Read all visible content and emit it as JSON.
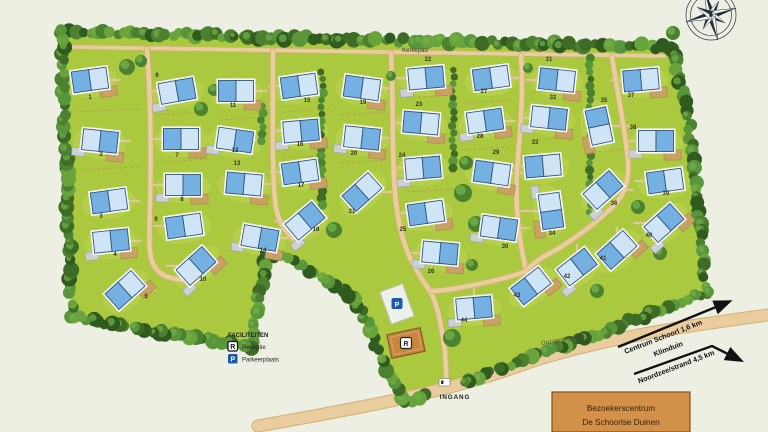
{
  "map": {
    "roads": {
      "kerkepad": "Kerkepad",
      "oorsprongweg": "Oorsprongweg"
    },
    "entrance_label": "INGANG",
    "legend": {
      "title": "FACILITEITEN",
      "items": [
        {
          "icon": "R",
          "label": "Receptie"
        },
        {
          "icon": "P",
          "label": "Parkeerplaats"
        }
      ]
    },
    "directions": [
      {
        "line1": "Centrum Schoorl 1,6 km",
        "line2": "Klimduin"
      },
      {
        "line1": "Noordzee/strand 4,5 km",
        "line2": ""
      }
    ],
    "visitor_center": {
      "line1": "Bezoekerscentrum",
      "line2": "De Schoorlse Duinen"
    },
    "compass_icon": "compass-rose-icon",
    "colors": {
      "background": "#edefe3",
      "park_green": "#aac93f",
      "lawn_light": "#c0d558",
      "tree_dark": "#3e6b26",
      "road_tan": "#e9cd9e",
      "house_blue_light": "#cfe4f5",
      "house_blue_mid": "#74b0e2",
      "house_outline": "#2e567d",
      "garage_tan": "#c8a165",
      "shed_gray": "#ccd0d4",
      "parking_blue": "#1d5aa8",
      "reception_brown": "#c8863f",
      "visitor_box_orange": "#d29049",
      "arrow_black": "#111111"
    },
    "houses": [
      {
        "n": 1,
        "x": 90,
        "y": 80,
        "r": -8,
        "lx": 90,
        "ly": 99,
        "d": "R"
      },
      {
        "n": 2,
        "x": 100,
        "y": 141,
        "r": 6,
        "lx": 101,
        "ly": 156,
        "d": "R"
      },
      {
        "n": 3,
        "x": 109,
        "y": 201,
        "r": -8,
        "lx": 101,
        "ly": 218,
        "d": "R"
      },
      {
        "n": 4,
        "x": 111,
        "y": 241,
        "r": -6,
        "lx": 115,
        "ly": 256,
        "d": "R"
      },
      {
        "n": 5,
        "x": 125,
        "y": 290,
        "r": -42,
        "lx": 146,
        "ly": 298,
        "d": "R"
      },
      {
        "n": 6,
        "x": 177,
        "y": 91,
        "r": -10,
        "lx": 157,
        "ly": 77,
        "d": "L"
      },
      {
        "n": 7,
        "x": 181,
        "y": 139,
        "r": 0,
        "lx": 177,
        "ly": 157,
        "d": "L"
      },
      {
        "n": 8,
        "x": 183,
        "y": 185,
        "r": 0,
        "lx": 182,
        "ly": 201,
        "d": "L"
      },
      {
        "n": 9,
        "x": 184,
        "y": 226,
        "r": -8,
        "lx": 156,
        "ly": 221,
        "d": "L"
      },
      {
        "n": 10,
        "x": 196,
        "y": 266,
        "r": -42,
        "lx": 203,
        "ly": 281,
        "d": "L"
      },
      {
        "n": 11,
        "x": 236,
        "y": 91,
        "r": 0,
        "lx": 233,
        "ly": 107,
        "d": "R"
      },
      {
        "n": 12,
        "x": 235,
        "y": 140,
        "r": 8,
        "lx": 235,
        "ly": 152,
        "d": "R"
      },
      {
        "n": 13,
        "x": 244,
        "y": 184,
        "r": 5,
        "lx": 237,
        "ly": 165,
        "d": "R"
      },
      {
        "n": 14,
        "x": 260,
        "y": 238,
        "r": 10,
        "lx": 263,
        "ly": 252,
        "d": "R"
      },
      {
        "n": 15,
        "x": 299,
        "y": 86,
        "r": -8,
        "lx": 307,
        "ly": 102,
        "d": "L"
      },
      {
        "n": 16,
        "x": 301,
        "y": 131,
        "r": -5,
        "lx": 300,
        "ly": 146,
        "d": "L"
      },
      {
        "n": 17,
        "x": 300,
        "y": 172,
        "r": -8,
        "lx": 301,
        "ly": 187,
        "d": "L"
      },
      {
        "n": 18,
        "x": 305,
        "y": 221,
        "r": -40,
        "lx": 316,
        "ly": 231,
        "d": "L"
      },
      {
        "n": 19,
        "x": 362,
        "y": 88,
        "r": 8,
        "lx": 363,
        "ly": 104,
        "d": "R"
      },
      {
        "n": 20,
        "x": 362,
        "y": 138,
        "r": 6,
        "lx": 354,
        "ly": 155,
        "d": "R"
      },
      {
        "n": 21,
        "x": 362,
        "y": 192,
        "r": -42,
        "lx": 352,
        "ly": 213,
        "d": "R"
      },
      {
        "n": 22,
        "x": 426,
        "y": 78,
        "r": -5,
        "lx": 428,
        "ly": 61,
        "d": "L"
      },
      {
        "n": 23,
        "x": 421,
        "y": 123,
        "r": 5,
        "lx": 419,
        "ly": 106,
        "d": "L"
      },
      {
        "n": 24,
        "x": 423,
        "y": 168,
        "r": -5,
        "lx": 402,
        "ly": 157,
        "d": "L"
      },
      {
        "n": 25,
        "x": 426,
        "y": 213,
        "r": -8,
        "lx": 403,
        "ly": 231,
        "d": "L"
      },
      {
        "n": 26,
        "x": 440,
        "y": 253,
        "r": 5,
        "lx": 431,
        "ly": 273,
        "d": "L"
      },
      {
        "n": 27,
        "x": 491,
        "y": 78,
        "r": -8,
        "lx": 484,
        "ly": 93,
        "d": "R"
      },
      {
        "n": 28,
        "x": 485,
        "y": 121,
        "r": -8,
        "lx": 480,
        "ly": 138,
        "d": "R"
      },
      {
        "n": 29,
        "x": 492,
        "y": 173,
        "r": 8,
        "lx": 496,
        "ly": 154,
        "d": "R"
      },
      {
        "n": 30,
        "x": 499,
        "y": 228,
        "r": 8,
        "lx": 505,
        "ly": 248,
        "d": "R"
      },
      {
        "n": 31,
        "x": 557,
        "y": 80,
        "r": 6,
        "lx": 549,
        "ly": 61,
        "d": "L"
      },
      {
        "n": 32,
        "x": 549,
        "y": 118,
        "r": 6,
        "lx": 553,
        "ly": 99,
        "d": "L"
      },
      {
        "n": 33,
        "x": 543,
        "y": 166,
        "r": -5,
        "lx": 535,
        "ly": 144,
        "d": "L"
      },
      {
        "n": 34,
        "x": 551,
        "y": 211,
        "r": 82,
        "lx": 552,
        "ly": 235,
        "d": "L"
      },
      {
        "n": 35,
        "x": 599,
        "y": 126,
        "r": 78,
        "lx": 604,
        "ly": 102,
        "d": "R"
      },
      {
        "n": 36,
        "x": 603,
        "y": 190,
        "r": -42,
        "lx": 614,
        "ly": 205,
        "d": "R"
      },
      {
        "n": 37,
        "x": 641,
        "y": 80,
        "r": -5,
        "lx": 631,
        "ly": 97,
        "d": "L"
      },
      {
        "n": 38,
        "x": 656,
        "y": 141,
        "r": 0,
        "lx": 633,
        "ly": 129,
        "d": "L"
      },
      {
        "n": 39,
        "x": 665,
        "y": 181,
        "r": -8,
        "lx": 666,
        "ly": 195,
        "d": "L"
      },
      {
        "n": 40,
        "x": 664,
        "y": 223,
        "r": -42,
        "lx": 649,
        "ly": 237,
        "d": "L"
      },
      {
        "n": 41,
        "x": 617,
        "y": 250,
        "r": -42,
        "lx": 603,
        "ly": 260,
        "d": "U"
      },
      {
        "n": 42,
        "x": 577,
        "y": 267,
        "r": -38,
        "lx": 567,
        "ly": 278,
        "d": "U"
      },
      {
        "n": 43,
        "x": 531,
        "y": 286,
        "r": -38,
        "lx": 517,
        "ly": 297,
        "d": "U"
      },
      {
        "n": 44,
        "x": 474,
        "y": 308,
        "r": -5,
        "lx": 464,
        "ly": 322,
        "d": "U"
      }
    ]
  }
}
